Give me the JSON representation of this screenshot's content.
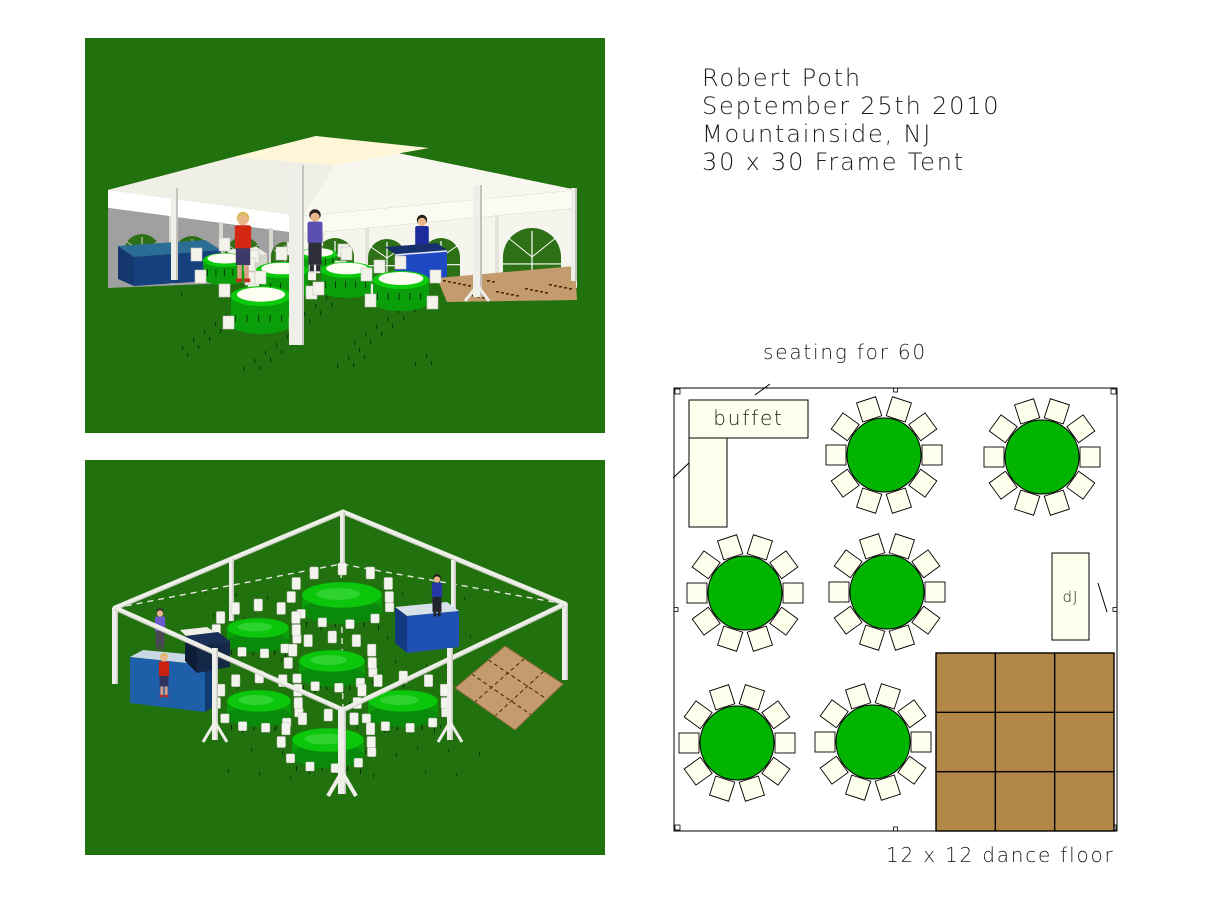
{
  "header": {
    "client_name": "Robert Poth",
    "event_date": "September 25th 2010",
    "location": "Mountainside, NJ",
    "tent": "30 x 30 Frame Tent"
  },
  "floor_plan": {
    "title": "seating for 60",
    "caption": "12 x 12 dance floor",
    "buffet_label": "buffet",
    "dj_label": "dJ",
    "table_count": 6,
    "seats_per_table": 10,
    "table_radius": 37,
    "chair_size": 20,
    "chair_offset": 48,
    "boundary": [
      6,
      6,
      443,
      443
    ],
    "tables": [
      {
        "cx": 216,
        "cy": 73
      },
      {
        "cx": 374,
        "cy": 75
      },
      {
        "cx": 77,
        "cy": 211
      },
      {
        "cx": 219,
        "cy": 210
      },
      {
        "cx": 69,
        "cy": 361
      },
      {
        "cx": 205,
        "cy": 360
      }
    ],
    "buffet_rects": [
      [
        21,
        18,
        119,
        38
      ],
      [
        21,
        56,
        38,
        89
      ]
    ],
    "dj_rect": [
      384,
      171,
      37,
      87
    ],
    "dance_floor_rect": [
      268,
      271,
      178,
      178
    ],
    "dance_floor_grid": 3,
    "diagonal_marks": [
      [
        87,
        13,
        102,
        2
      ],
      [
        5,
        96,
        22,
        80
      ],
      [
        430,
        201,
        439,
        230
      ]
    ]
  },
  "colors": {
    "page_bg": "#FFFFFF",
    "ink": "#1C1C1C",
    "grass_green": "#22710F",
    "plan_table_green": "#00B400",
    "chair_ivory": "#FFFFEE",
    "plan_brown": "#B28748",
    "render_tan": "#C49B6C",
    "tent_white": "#F7F7EF",
    "canopy_cream": "#FFF6D8",
    "wall_gray": "#A0A0A0",
    "window_green": "#2E7016",
    "pole_white": "#EFEFE9",
    "counter_navy": "#14386E",
    "counter_blue": "#1D5FA8",
    "royal_blue": "#1F48C4",
    "table_green_bright": "#0CC60C",
    "table_green_body": "#0B9E0B"
  }
}
